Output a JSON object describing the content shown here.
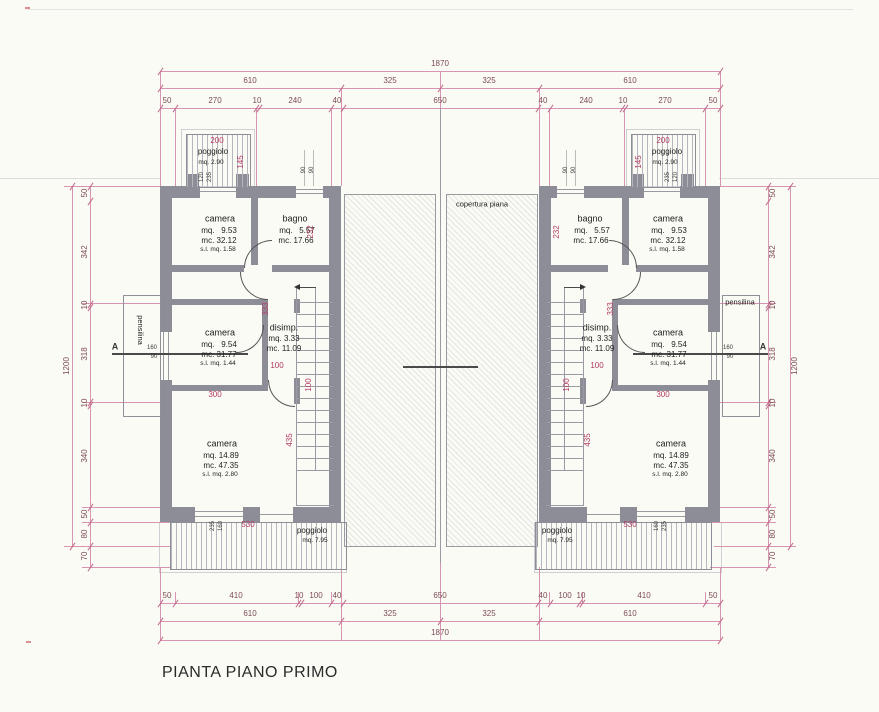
{
  "title": "PIANTA PIANO PRIMO",
  "labels": {
    "copertura": "copertura piana",
    "pensilina": "pensilina",
    "section_marker": "A"
  },
  "rooms": {
    "camera_top": {
      "name": "camera",
      "l1": "mq.   9.53",
      "l2": "mc. 32.12",
      "l3": "s.l. mq. 1.58"
    },
    "bagno": {
      "name": "bagno",
      "l1": "mq.   5.57",
      "l2": "mc. 17.66"
    },
    "camera_mid": {
      "name": "camera",
      "l1": "mq.   9.54",
      "l2": "mc. 31.77",
      "l3": "s.l. mq. 1.44"
    },
    "disimp": {
      "name": "disimp.",
      "l1": "mq. 3.33",
      "l2": "mc. 11.09"
    },
    "camera_bottom": {
      "name": "camera",
      "l1": "mq. 14.89",
      "l2": "mc. 47.35",
      "l3": "s.l. mq. 2.80"
    },
    "poggiolo_top": {
      "name": "poggiolo",
      "l1": "mq. 2.90"
    },
    "poggiolo_bottom": {
      "name": "poggiolo",
      "l1": "mq. 7.95"
    }
  },
  "dims": {
    "n1870": "1870",
    "n610": "610",
    "n325": "325",
    "n650": "650",
    "n50": "50",
    "n270": "270",
    "n10": "10",
    "n240": "240",
    "n40": "40",
    "n410": "410",
    "n100": "100",
    "n1200": "1200",
    "n342": "342",
    "n318": "318",
    "n340": "340",
    "n80": "80",
    "n70": "70",
    "n200": "200",
    "n145": "145",
    "n232": "232",
    "n333": "333",
    "n300": "300",
    "n435": "435",
    "n530": "530",
    "n235": "235",
    "n160": "160",
    "n90": "90",
    "n120": "120"
  },
  "colors": {
    "wall": "#8d8d98",
    "dimension_text": "#7c4c52",
    "dimension_accent": "#b13b64",
    "dimension_line": "#d795b1",
    "room_text": "#1c1c1c"
  }
}
